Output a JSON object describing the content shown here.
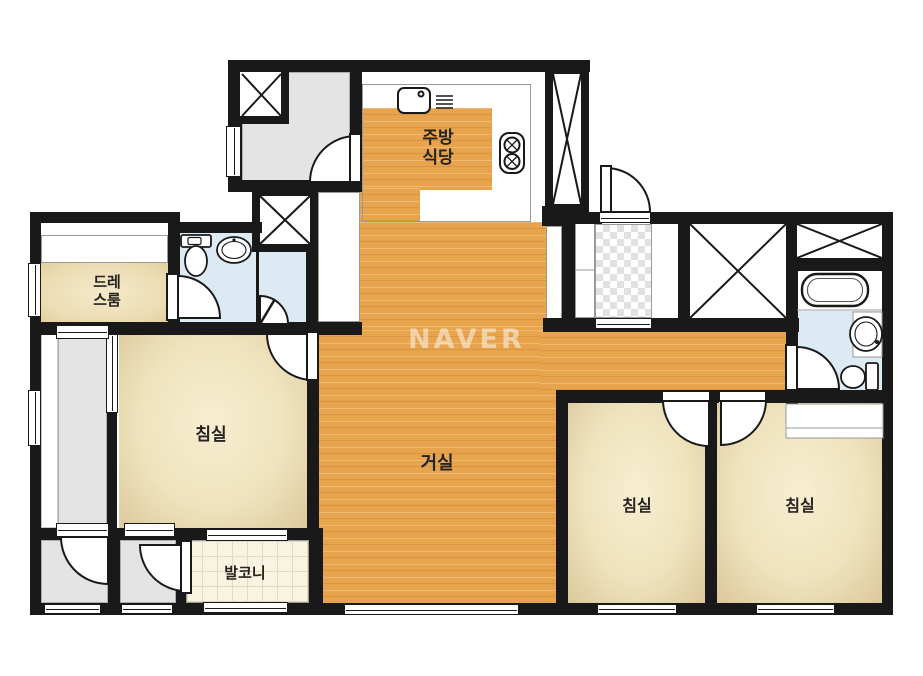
{
  "watermark": "NAVER",
  "labels": {
    "kitchen_l1": "주방",
    "kitchen_l2": "식당",
    "dress_l1": "드레",
    "dress_l2": "스룸",
    "bedroom1": "침실",
    "bedroom2": "침실",
    "bedroom3": "침실",
    "living": "거실",
    "balcony": "발코니"
  },
  "colors": {
    "wall": "#191919",
    "wood_floor": "#e7a44d",
    "bedroom_floor": "#efe3bd",
    "bathroom_floor": "#dcebf3",
    "utility_gray": "#e4e4e4",
    "balcony_tile": "#f9f3e1",
    "watermark_white": "#ffffff"
  },
  "icons": [
    "sink-icon",
    "range-burner-icon",
    "vent-grill-icon",
    "toilet-icon",
    "washbasin-icon",
    "bathtub-icon",
    "door-swing-icon",
    "shaft-x-icon",
    "closet-x-icon",
    "window-icon",
    "checker-entry-floor"
  ]
}
